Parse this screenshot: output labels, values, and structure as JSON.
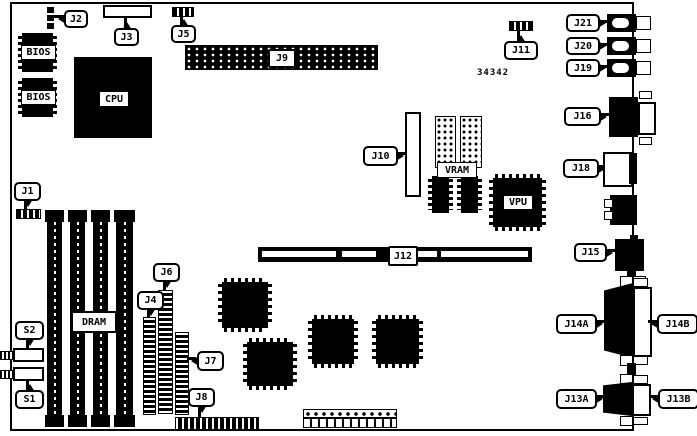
{
  "board": {
    "drawing_number": "34342",
    "colors": {
      "ink": "#000000",
      "paper": "#ffffff"
    },
    "labels": {
      "j1": "J1",
      "j2": "J2",
      "j3": "J3",
      "j4": "J4",
      "j5": "J5",
      "j6": "J6",
      "j7": "J7",
      "j8": "J8",
      "j9": "J9",
      "j10": "J10",
      "j11": "J11",
      "j12": "J12",
      "j13a": "J13A",
      "j13b": "J13B",
      "j14a": "J14A",
      "j14b": "J14B",
      "j15": "J15",
      "j16": "J16",
      "j18": "J18",
      "j19": "J19",
      "j20": "J20",
      "j21": "J21",
      "s1": "S1",
      "s2": "S2",
      "bios": "BIOS",
      "cpu": "CPU",
      "dram": "DRAM",
      "vram": "VRAM",
      "vpu": "VPU"
    }
  }
}
